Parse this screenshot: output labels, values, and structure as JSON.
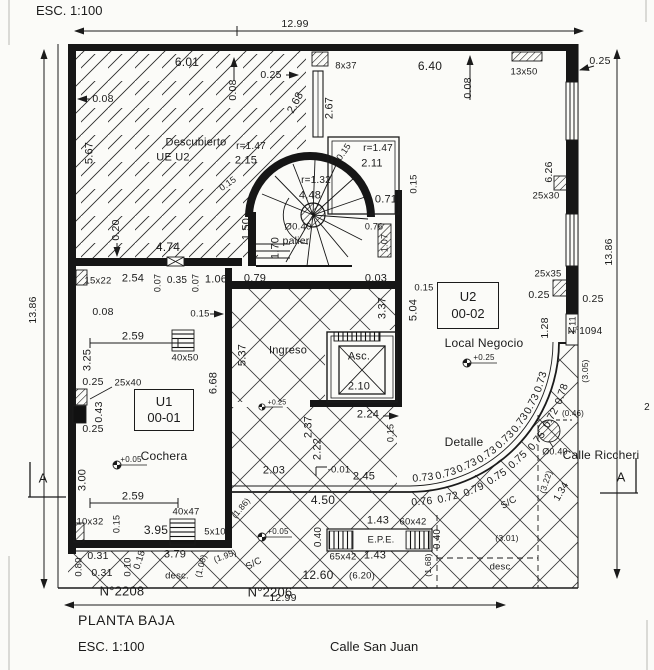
{
  "plan": {
    "scale_top": "ESC. 1:100",
    "title": "PLANTA BAJA",
    "scale_bottom": "ESC. 1:100",
    "street_bottom": "Calle San Juan",
    "street_right": "Calle Riccheri",
    "address_left": "N°2208",
    "address_mid": "N°2206",
    "address_right": "N°1094",
    "section_marker": "A",
    "overall": {
      "width_top": "12.99",
      "width_bottom": "12.99",
      "height_left": "13.86",
      "height_right": "13.86"
    }
  },
  "units": [
    {
      "id": "U1",
      "code": "00-01",
      "room": "Cochera"
    },
    {
      "id": "U2",
      "code": "00-02",
      "room": "Local Negocio"
    }
  ],
  "rooms": [
    "Descubierto UE U2",
    "Ingreso",
    "palier",
    "Asc.",
    "Cochera",
    "Local Negocio",
    "Detalle"
  ],
  "levels": [
    "+0.05",
    "+0.25",
    "-0.01"
  ],
  "labels": [
    {
      "t": "12.99",
      "x": 295,
      "y": 24
    },
    {
      "t": "12.99",
      "x": 283,
      "y": 598
    },
    {
      "t": "13.86",
      "x": 33,
      "y": 310,
      "r": -90
    },
    {
      "t": "13.86",
      "x": 609,
      "y": 252,
      "r": -90
    },
    {
      "t": "6.01",
      "x": 187,
      "y": 62,
      "fs": 12
    },
    {
      "t": "0.08",
      "x": 103,
      "y": 99
    },
    {
      "t": "0.08",
      "x": 233,
      "y": 90,
      "r": -90
    },
    {
      "t": "0.25",
      "x": 271,
      "y": 75
    },
    {
      "t": "8x37",
      "x": 346,
      "y": 66,
      "fs": 9.5
    },
    {
      "t": "6.40",
      "x": 430,
      "y": 66,
      "fs": 12
    },
    {
      "t": "0.08",
      "x": 468,
      "y": 88,
      "r": -90
    },
    {
      "t": "13x50",
      "x": 524,
      "y": 72,
      "fs": 9.5
    },
    {
      "t": "0.25",
      "x": 600,
      "y": 61
    },
    {
      "t": "2.68",
      "x": 296,
      "y": 103,
      "r": -62,
      "fs": 11
    },
    {
      "t": "2.67",
      "x": 330,
      "y": 108,
      "r": -90,
      "fs": 11
    },
    {
      "t": "5.67",
      "x": 90,
      "y": 153,
      "r": -90,
      "fs": 11
    },
    {
      "t": "Descubierto",
      "x": 196,
      "y": 143,
      "fs": 11
    },
    {
      "t": "UE U2",
      "x": 173,
      "y": 158,
      "fs": 11
    },
    {
      "t": "r=1.47",
      "x": 251,
      "y": 147,
      "fs": 10
    },
    {
      "t": "2.15",
      "x": 246,
      "y": 161,
      "fs": 11
    },
    {
      "t": "0.15",
      "x": 228,
      "y": 184,
      "r": -35,
      "fs": 9
    },
    {
      "t": "r=1.47",
      "x": 378,
      "y": 149,
      "fs": 10
    },
    {
      "t": "2.11",
      "x": 372,
      "y": 164,
      "fs": 11
    },
    {
      "t": "0.15",
      "x": 344,
      "y": 152,
      "r": -55,
      "fs": 9
    },
    {
      "t": "r=1.32",
      "x": 316,
      "y": 181,
      "fs": 10
    },
    {
      "t": "4.48",
      "x": 310,
      "y": 196,
      "fs": 11
    },
    {
      "t": "0.71",
      "x": 386,
      "y": 200,
      "fs": 11
    },
    {
      "t": "0.15",
      "x": 414,
      "y": 184,
      "r": -90,
      "fs": 9.5
    },
    {
      "t": "Ø0.40",
      "x": 298,
      "y": 227,
      "fs": 9.5
    },
    {
      "t": "palier",
      "x": 296,
      "y": 241,
      "fs": 10.5
    },
    {
      "t": "1.50",
      "x": 247,
      "y": 229,
      "r": -90,
      "fs": 11
    },
    {
      "t": "1.70",
      "x": 276,
      "y": 248,
      "r": -90,
      "fs": 11
    },
    {
      "t": "0.76",
      "x": 374,
      "y": 227,
      "fs": 9
    },
    {
      "t": "1.07",
      "x": 385,
      "y": 243,
      "r": -90,
      "fs": 9
    },
    {
      "t": "0.20",
      "x": 116,
      "y": 230,
      "r": -90
    },
    {
      "t": "4.74",
      "x": 168,
      "y": 247,
      "fs": 12
    },
    {
      "t": "15x22",
      "x": 98,
      "y": 281,
      "fs": 9.5
    },
    {
      "t": "2.54",
      "x": 133,
      "y": 279,
      "fs": 11
    },
    {
      "t": "0.07",
      "x": 158,
      "y": 283,
      "r": -90,
      "fs": 9
    },
    {
      "t": "0.35",
      "x": 177,
      "y": 281,
      "fs": 10
    },
    {
      "t": "0.07",
      "x": 196,
      "y": 283,
      "r": -90,
      "fs": 9
    },
    {
      "t": "1.06",
      "x": 216,
      "y": 280,
      "fs": 11
    },
    {
      "t": "0.79",
      "x": 255,
      "y": 279,
      "fs": 11
    },
    {
      "t": "0.03",
      "x": 376,
      "y": 279,
      "fs": 11
    },
    {
      "t": "3.37",
      "x": 383,
      "y": 308,
      "r": -90,
      "fs": 11
    },
    {
      "t": "5.04",
      "x": 414,
      "y": 310,
      "r": -90,
      "fs": 11
    },
    {
      "t": "0.15",
      "x": 424,
      "y": 288,
      "fs": 9.5
    },
    {
      "t": "0.08",
      "x": 103,
      "y": 312
    },
    {
      "t": "0.15",
      "x": 200,
      "y": 314,
      "fs": 9.5
    },
    {
      "t": "Ingreso",
      "x": 288,
      "y": 351,
      "fs": 11
    },
    {
      "t": "5.37",
      "x": 243,
      "y": 355,
      "r": -90,
      "fs": 11
    },
    {
      "t": "2.59",
      "x": 133,
      "y": 337,
      "fs": 11
    },
    {
      "t": "40x50",
      "x": 185,
      "y": 358,
      "fs": 9.5
    },
    {
      "t": "3.25",
      "x": 88,
      "y": 360,
      "r": -90,
      "fs": 11
    },
    {
      "t": "0.25",
      "x": 93,
      "y": 382,
      "fs": 10.5
    },
    {
      "t": "25x40",
      "x": 128,
      "y": 383,
      "fs": 9.5
    },
    {
      "t": "0.43",
      "x": 99,
      "y": 412,
      "r": -90,
      "fs": 10.5
    },
    {
      "t": "0.25",
      "x": 93,
      "y": 429,
      "fs": 10.5
    },
    {
      "t": "6.68",
      "x": 214,
      "y": 383,
      "r": -90,
      "fs": 11
    },
    {
      "t": "+0.05",
      "x": 131,
      "y": 460,
      "fs": 8
    },
    {
      "t": "3.00",
      "x": 83,
      "y": 480,
      "r": -90,
      "fs": 11
    },
    {
      "t": "2.59",
      "x": 133,
      "y": 497,
      "fs": 11
    },
    {
      "t": "40x47",
      "x": 186,
      "y": 512,
      "fs": 9.5
    },
    {
      "t": "10x32",
      "x": 90,
      "y": 522,
      "fs": 9.5
    },
    {
      "t": "0.15",
      "x": 117,
      "y": 524,
      "r": -90,
      "fs": 9
    },
    {
      "t": "3.95",
      "x": 156,
      "y": 530,
      "fs": 12
    },
    {
      "t": "5x10",
      "x": 215,
      "y": 532,
      "fs": 9.5
    },
    {
      "t": "Asc.",
      "x": 359,
      "y": 357,
      "fs": 11
    },
    {
      "t": "2.10",
      "x": 359,
      "y": 387,
      "fs": 11
    },
    {
      "t": "2.24",
      "x": 368,
      "y": 415,
      "fs": 11
    },
    {
      "t": "0.15",
      "x": 391,
      "y": 433,
      "r": -90,
      "fs": 9
    },
    {
      "t": "2.37",
      "x": 309,
      "y": 427,
      "r": -90,
      "fs": 11
    },
    {
      "t": "2.22",
      "x": 318,
      "y": 449,
      "r": -90,
      "fs": 11
    },
    {
      "t": "+0.25",
      "x": 484,
      "y": 358,
      "fs": 8
    },
    {
      "t": "+0.25",
      "x": 277,
      "y": 403,
      "fs": 7
    },
    {
      "t": "Detalle",
      "x": 464,
      "y": 442,
      "fs": 12
    },
    {
      "t": "25x35",
      "x": 548,
      "y": 274,
      "fs": 9.5
    },
    {
      "t": "0.25",
      "x": 539,
      "y": 295,
      "fs": 10.5
    },
    {
      "t": "0.25",
      "x": 593,
      "y": 299,
      "fs": 10.5
    },
    {
      "t": "1.28",
      "x": 545,
      "y": 328,
      "r": -90,
      "fs": 10.5
    },
    {
      "t": "1.11",
      "x": 573,
      "y": 325,
      "r": -90,
      "fs": 9
    },
    {
      "t": "(3.05)",
      "x": 585,
      "y": 371,
      "r": -90,
      "fs": 8.5
    },
    {
      "t": "6.26",
      "x": 549,
      "y": 172,
      "r": -90,
      "fs": 10.5
    },
    {
      "t": "25x30",
      "x": 546,
      "y": 196,
      "fs": 9.5
    },
    {
      "t": "2.03",
      "x": 274,
      "y": 471,
      "fs": 11
    },
    {
      "t": "-0.01",
      "x": 339,
      "y": 470,
      "fs": 9.5
    },
    {
      "t": "2.45",
      "x": 364,
      "y": 477,
      "fs": 11
    },
    {
      "t": "4.50",
      "x": 323,
      "y": 500,
      "fs": 12
    },
    {
      "t": "1.43",
      "x": 378,
      "y": 521,
      "fs": 11
    },
    {
      "t": "60x42",
      "x": 413,
      "y": 522,
      "fs": 9.5
    },
    {
      "t": "0.40",
      "x": 319,
      "y": 537,
      "r": -90,
      "fs": 10
    },
    {
      "t": "E.P.E.",
      "x": 381,
      "y": 540,
      "fs": 9.5
    },
    {
      "t": "65x42",
      "x": 343,
      "y": 557,
      "fs": 9.5
    },
    {
      "t": "1.43",
      "x": 375,
      "y": 556,
      "fs": 11
    },
    {
      "t": "0.40",
      "x": 438,
      "y": 539,
      "r": -90,
      "fs": 10
    },
    {
      "t": "12.60",
      "x": 318,
      "y": 575,
      "fs": 12
    },
    {
      "t": "(6.20)",
      "x": 362,
      "y": 576,
      "fs": 9.5
    },
    {
      "t": "(1.68)",
      "x": 428,
      "y": 565,
      "r": -90,
      "fs": 8.5
    },
    {
      "t": "desc",
      "x": 500,
      "y": 567,
      "fs": 9.5
    },
    {
      "t": "(3.01)",
      "x": 507,
      "y": 538,
      "fs": 8.5
    },
    {
      "t": "+0.05",
      "x": 278,
      "y": 532,
      "fs": 8
    },
    {
      "t": "S/C",
      "x": 254,
      "y": 564,
      "r": -28,
      "fs": 9.5
    },
    {
      "t": "desc.",
      "x": 177,
      "y": 576,
      "fs": 9.5
    },
    {
      "t": "(1.08)",
      "x": 201,
      "y": 566,
      "r": -75,
      "fs": 8.5
    },
    {
      "t": "(1.95)",
      "x": 225,
      "y": 556,
      "r": -20,
      "fs": 8.5
    },
    {
      "t": "(1.86)",
      "x": 241,
      "y": 508,
      "r": -50,
      "fs": 8.5
    },
    {
      "t": "0.31",
      "x": 98,
      "y": 556,
      "fs": 10.5
    },
    {
      "t": "0.31",
      "x": 102,
      "y": 573,
      "fs": 10.5
    },
    {
      "t": "0.10",
      "x": 128,
      "y": 567,
      "r": -90,
      "fs": 9.5
    },
    {
      "t": "0.18",
      "x": 140,
      "y": 560,
      "r": -72,
      "fs": 9.5
    },
    {
      "t": "3.79",
      "x": 175,
      "y": 555,
      "fs": 11
    },
    {
      "t": "0.80",
      "x": 79,
      "y": 567,
      "r": -90,
      "fs": 9.5
    },
    {
      "t": "S/C",
      "x": 509,
      "y": 503,
      "r": -30,
      "fs": 9.5
    },
    {
      "t": "Ø0.40",
      "x": 555,
      "y": 452,
      "fs": 9
    },
    {
      "t": "(0.46)",
      "x": 573,
      "y": 414,
      "fs": 8
    },
    {
      "t": "(3.22)",
      "x": 546,
      "y": 482,
      "r": -72,
      "fs": 8.5
    },
    {
      "t": "1.34",
      "x": 562,
      "y": 492,
      "r": -60,
      "fs": 10
    },
    {
      "t": "2",
      "x": 647,
      "y": 408,
      "fs": 10
    },
    {
      "t": "0.73",
      "x": 423,
      "y": 478,
      "r": -6
    },
    {
      "t": "0.73",
      "x": 446,
      "y": 474,
      "r": -16
    },
    {
      "t": "0.73",
      "x": 467,
      "y": 466,
      "r": -25
    },
    {
      "t": "0.73",
      "x": 487,
      "y": 455,
      "r": -35
    },
    {
      "t": "0.73",
      "x": 505,
      "y": 440,
      "r": -44
    },
    {
      "t": "0.73",
      "x": 520,
      "y": 423,
      "r": -54
    },
    {
      "t": "0.73",
      "x": 532,
      "y": 404,
      "r": -63
    },
    {
      "t": "0.73",
      "x": 541,
      "y": 382,
      "r": -73
    },
    {
      "t": "0.76",
      "x": 422,
      "y": 502,
      "r": -5
    },
    {
      "t": "0.72",
      "x": 448,
      "y": 498,
      "r": -14
    },
    {
      "t": "0.79",
      "x": 474,
      "y": 490,
      "r": -24
    },
    {
      "t": "0.75",
      "x": 497,
      "y": 477,
      "r": -33
    },
    {
      "t": "0.75",
      "x": 518,
      "y": 460,
      "r": -43
    },
    {
      "t": "0.75",
      "x": 537,
      "y": 441,
      "r": -52
    },
    {
      "t": "0.72",
      "x": 551,
      "y": 418,
      "r": -62
    },
    {
      "t": "0.78",
      "x": 562,
      "y": 394,
      "r": -71
    }
  ]
}
